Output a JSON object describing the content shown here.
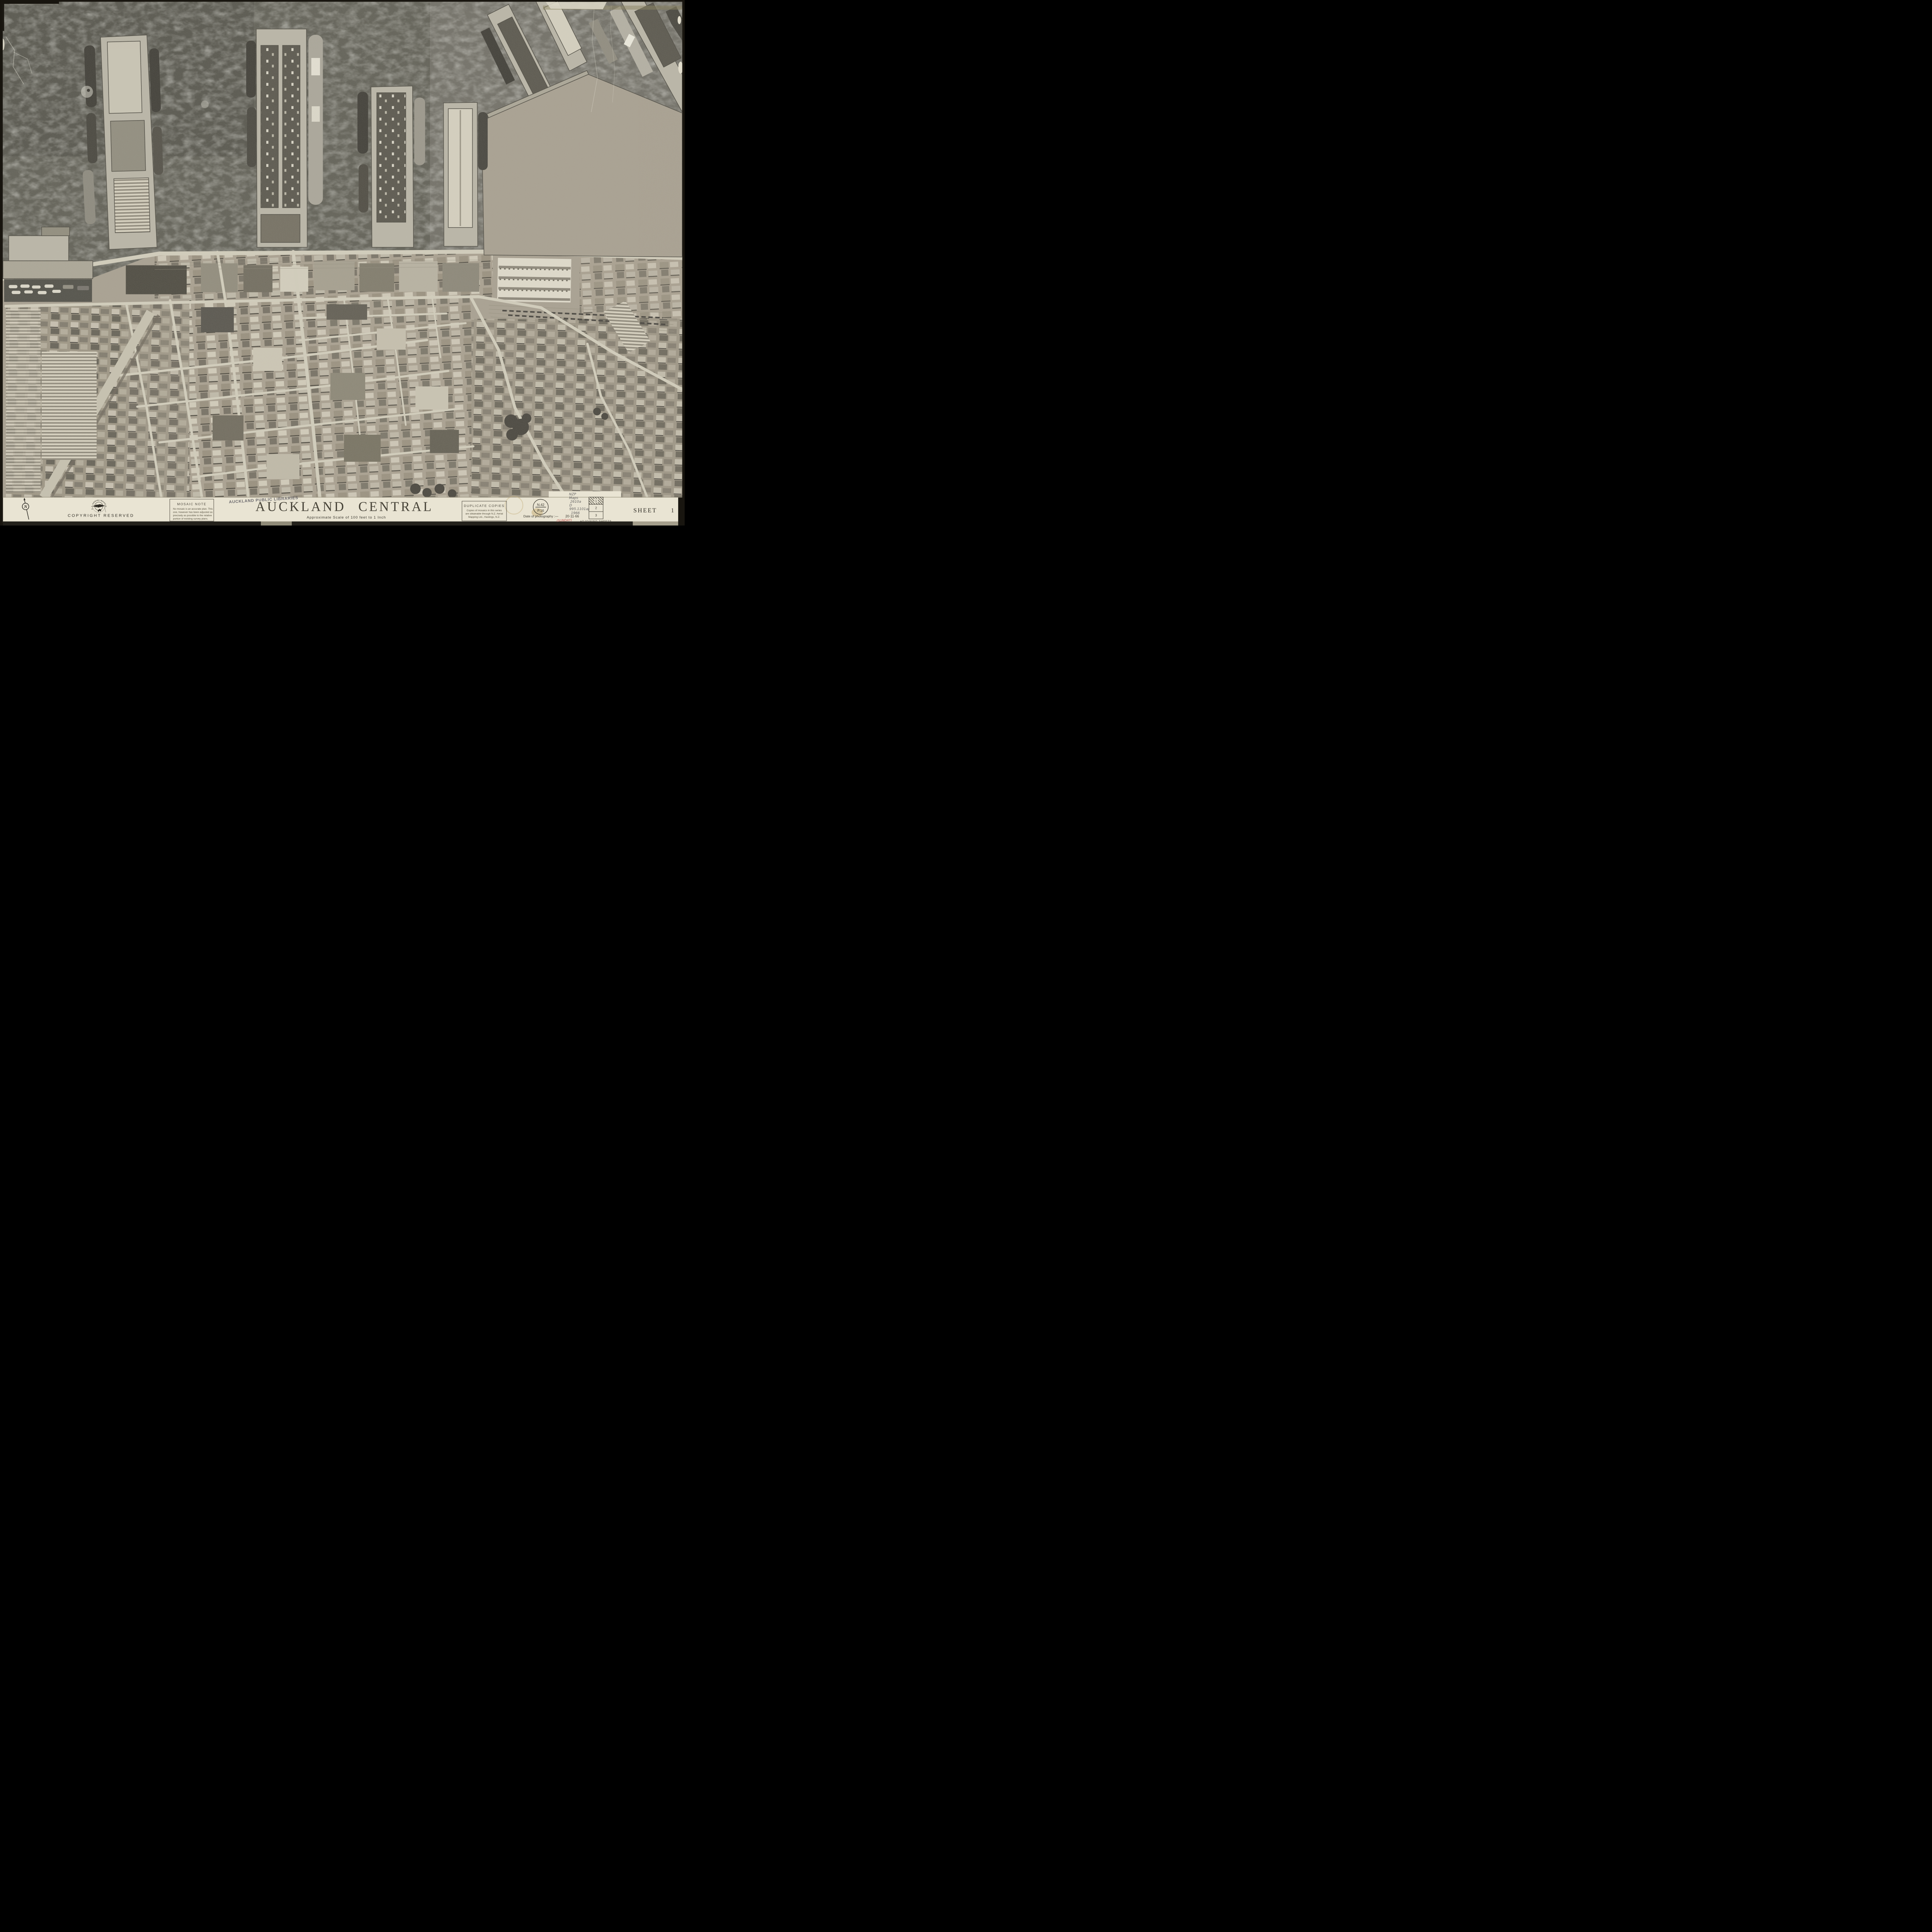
{
  "sheet": {
    "title": "AUCKLAND CENTRAL",
    "title_words": [
      "AUCKLAND",
      "CENTRAL"
    ],
    "scale_note": "Approximate Scale of 100 feet to 1 Inch",
    "sheet_label": "SHEET",
    "sheet_number": "1",
    "copyright": "COPYRIGHT RESERVED",
    "north_label": "N"
  },
  "publisher_logo": {
    "arc_text": "N.Z. AERIAL MAPPING",
    "side_text": "HASTINGS"
  },
  "mosaic_note": {
    "heading": "MOSAIC NOTE",
    "lines": [
      "No mosaic is an accurate plan. This",
      "one, however has been adjusted as",
      "precisely as possible to the relative",
      "portion of existing survey plans."
    ]
  },
  "library_stamp": "AUCKLAND PUBLIC LIBRARIES",
  "duplicate_copies": {
    "heading": "DUPLICATE COPIES",
    "lines": [
      "Copies of mosaics in this series",
      "are obtainable through N.Z. Aerial",
      "Mapping Ltd., Hastings, N.Z."
    ]
  },
  "file_stamp": {
    "top": "N.42",
    "bottom": "P.16"
  },
  "photography": {
    "label": "Date of photography :—",
    "date": "20·11·66",
    "annotation": "(SUNDAY)"
  },
  "handwritten": {
    "lines": [
      "NZP",
      "Maps",
      "2610a",
      "D",
      "995.1101ap",
      "1966"
    ]
  },
  "adjoining_sheets": {
    "label": "ADJOINING SHEETS",
    "sheets": [
      "1",
      "2",
      "3"
    ],
    "highlighted": "1"
  },
  "colors": {
    "paper": "#e9e4d3",
    "ink": "#34312a",
    "red_annotation": "#c0504d",
    "water": "#5e5d53",
    "land": "#a79f8f",
    "mount_black": "#18150f"
  }
}
